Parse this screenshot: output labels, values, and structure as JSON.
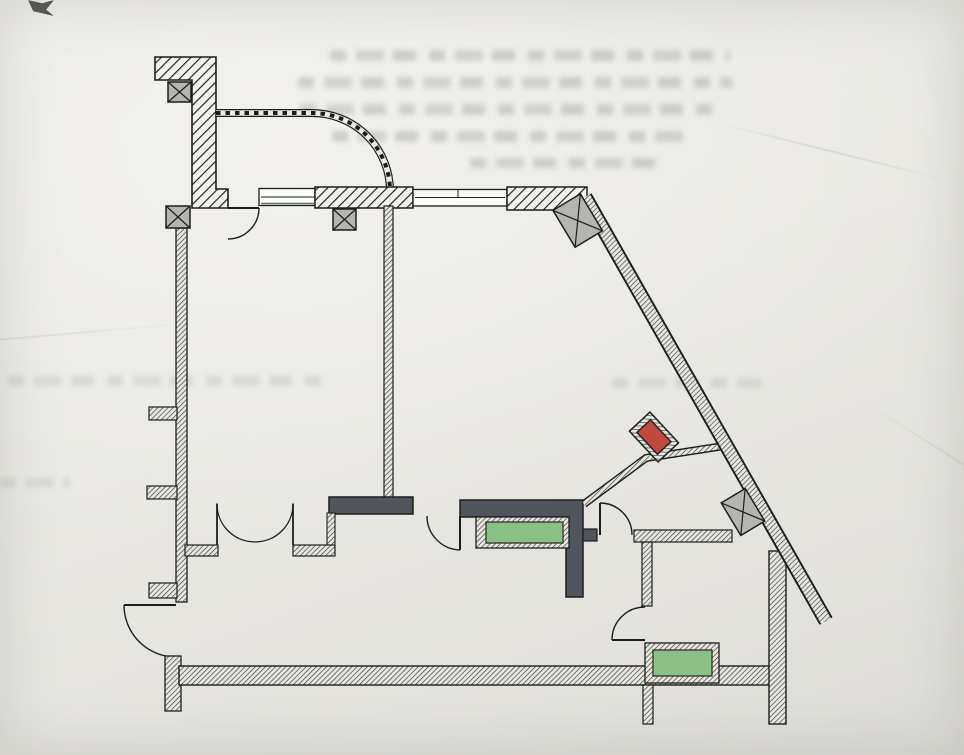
{
  "palette": {
    "paper": "#e9e8e3",
    "ink": "#1d1d1b",
    "wall_hatch_fill": "#f2f1ec",
    "thin_wall_fill": "#e6e5df",
    "solid_wall": "#50545d",
    "column_fill": "#b5b4b1",
    "shaft_red": "#c0493f",
    "shaft_red_border": "#2a2220",
    "fixture_green": "#8cc186",
    "fixture_green_border": "#2f2f2c",
    "window_fill": "#fbfbf8",
    "window_sill_green": "#5d7a5a"
  },
  "elements": {
    "walls": [
      "top-left-l-wall",
      "top-window-pier",
      "top-right-wall",
      "diagonal-exterior-wall",
      "left-exterior-wall",
      "bottom-exterior-wall",
      "right-exterior-wall",
      "middle-partition",
      "partition-bar-left",
      "partition-bar-right",
      "bathroom-partition-horizontal",
      "bathroom-partition-vertical",
      "thin-diagonal-partition"
    ],
    "columns": [
      "column-top-left",
      "column-left",
      "column-top-middle",
      "column-top-right-corner",
      "column-on-diagonal"
    ],
    "openings": [
      "curved-dashed-canopy",
      "window-left",
      "window-right",
      "double-swing-door",
      "entry-door",
      "door-top-left-room",
      "door-between-bars",
      "door-hall",
      "bathroom-door"
    ],
    "fixtures": [
      "red-duct-shaft",
      "green-fixture-hall",
      "green-fixture-bathroom"
    ]
  }
}
